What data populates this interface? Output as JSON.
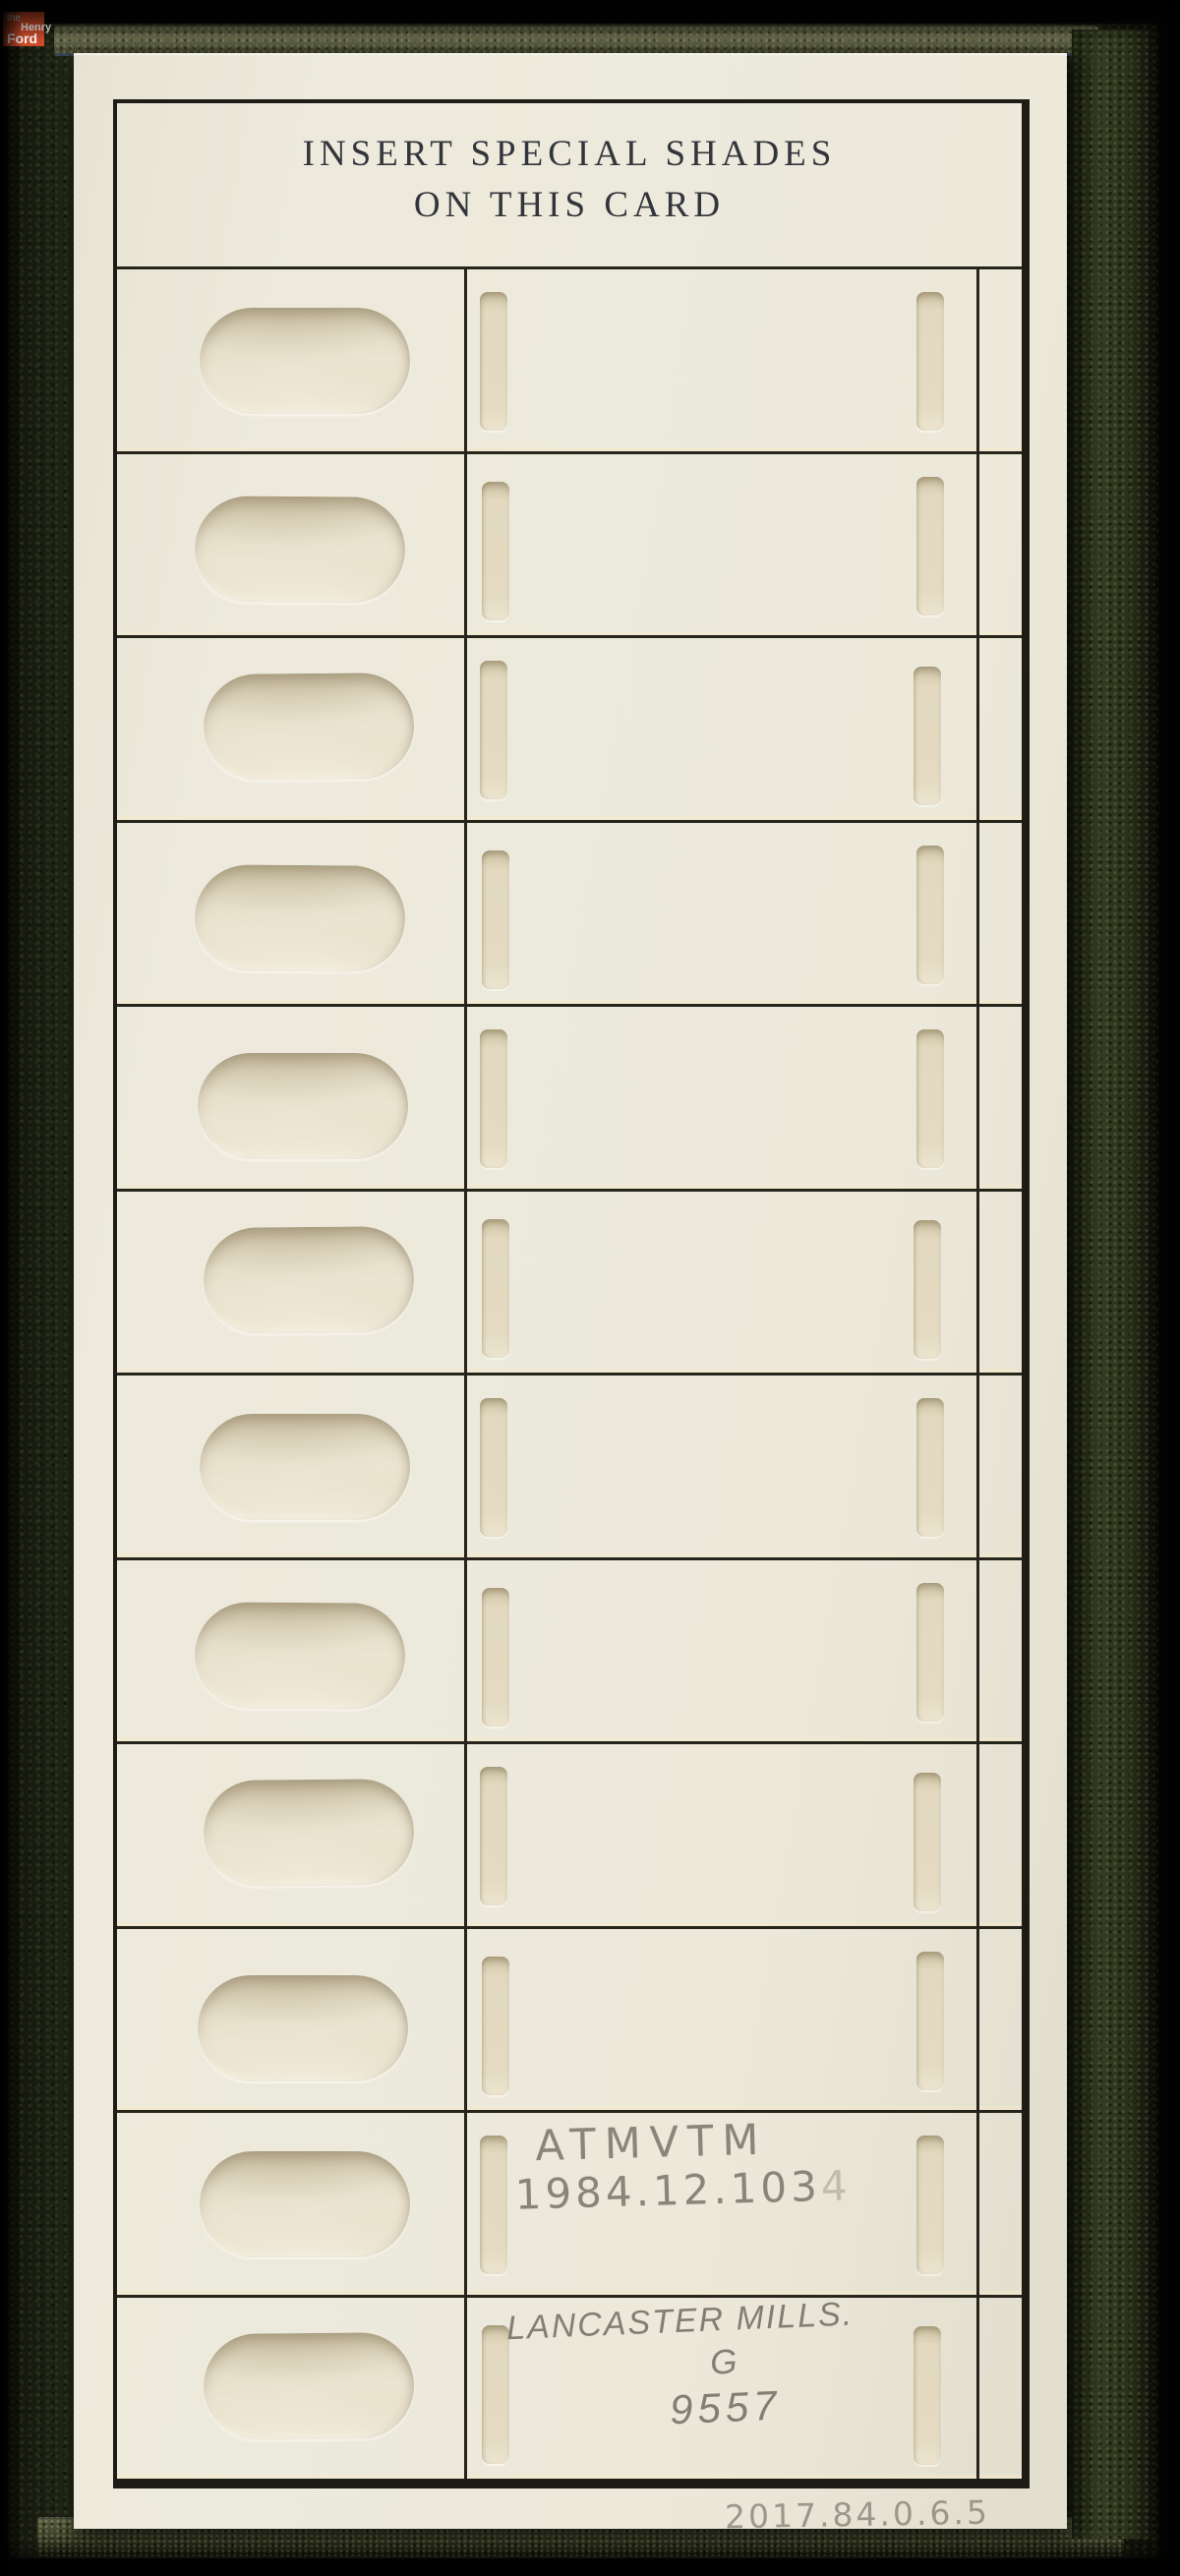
{
  "logo": {
    "word_the": "the",
    "word_henry": "Henry",
    "word_ford": "Ford",
    "bg_color": "#cf4b28",
    "text_color": "#ffffff"
  },
  "card": {
    "title_line1": "INSERT SPECIAL SHADES",
    "title_line2": "ON THIS CARD",
    "row_count": 12,
    "rows": [
      {},
      {},
      {},
      {},
      {},
      {},
      {},
      {},
      {},
      {},
      {
        "note_line1": "ATMVTM",
        "note_line2": "1984.12.103",
        "note_faint_suffix": "4"
      },
      {
        "note_line1": "LANCASTER MILLS.",
        "note_line2": "G",
        "note_line3": "9557"
      }
    ],
    "accession_number": "2017.84.0.6.5"
  },
  "colors": {
    "paper": "#ece9db",
    "leather": "#252b1a",
    "frame_line": "#26251c",
    "pencil": "#8b8478",
    "logo_accent": "#cf4b28"
  }
}
